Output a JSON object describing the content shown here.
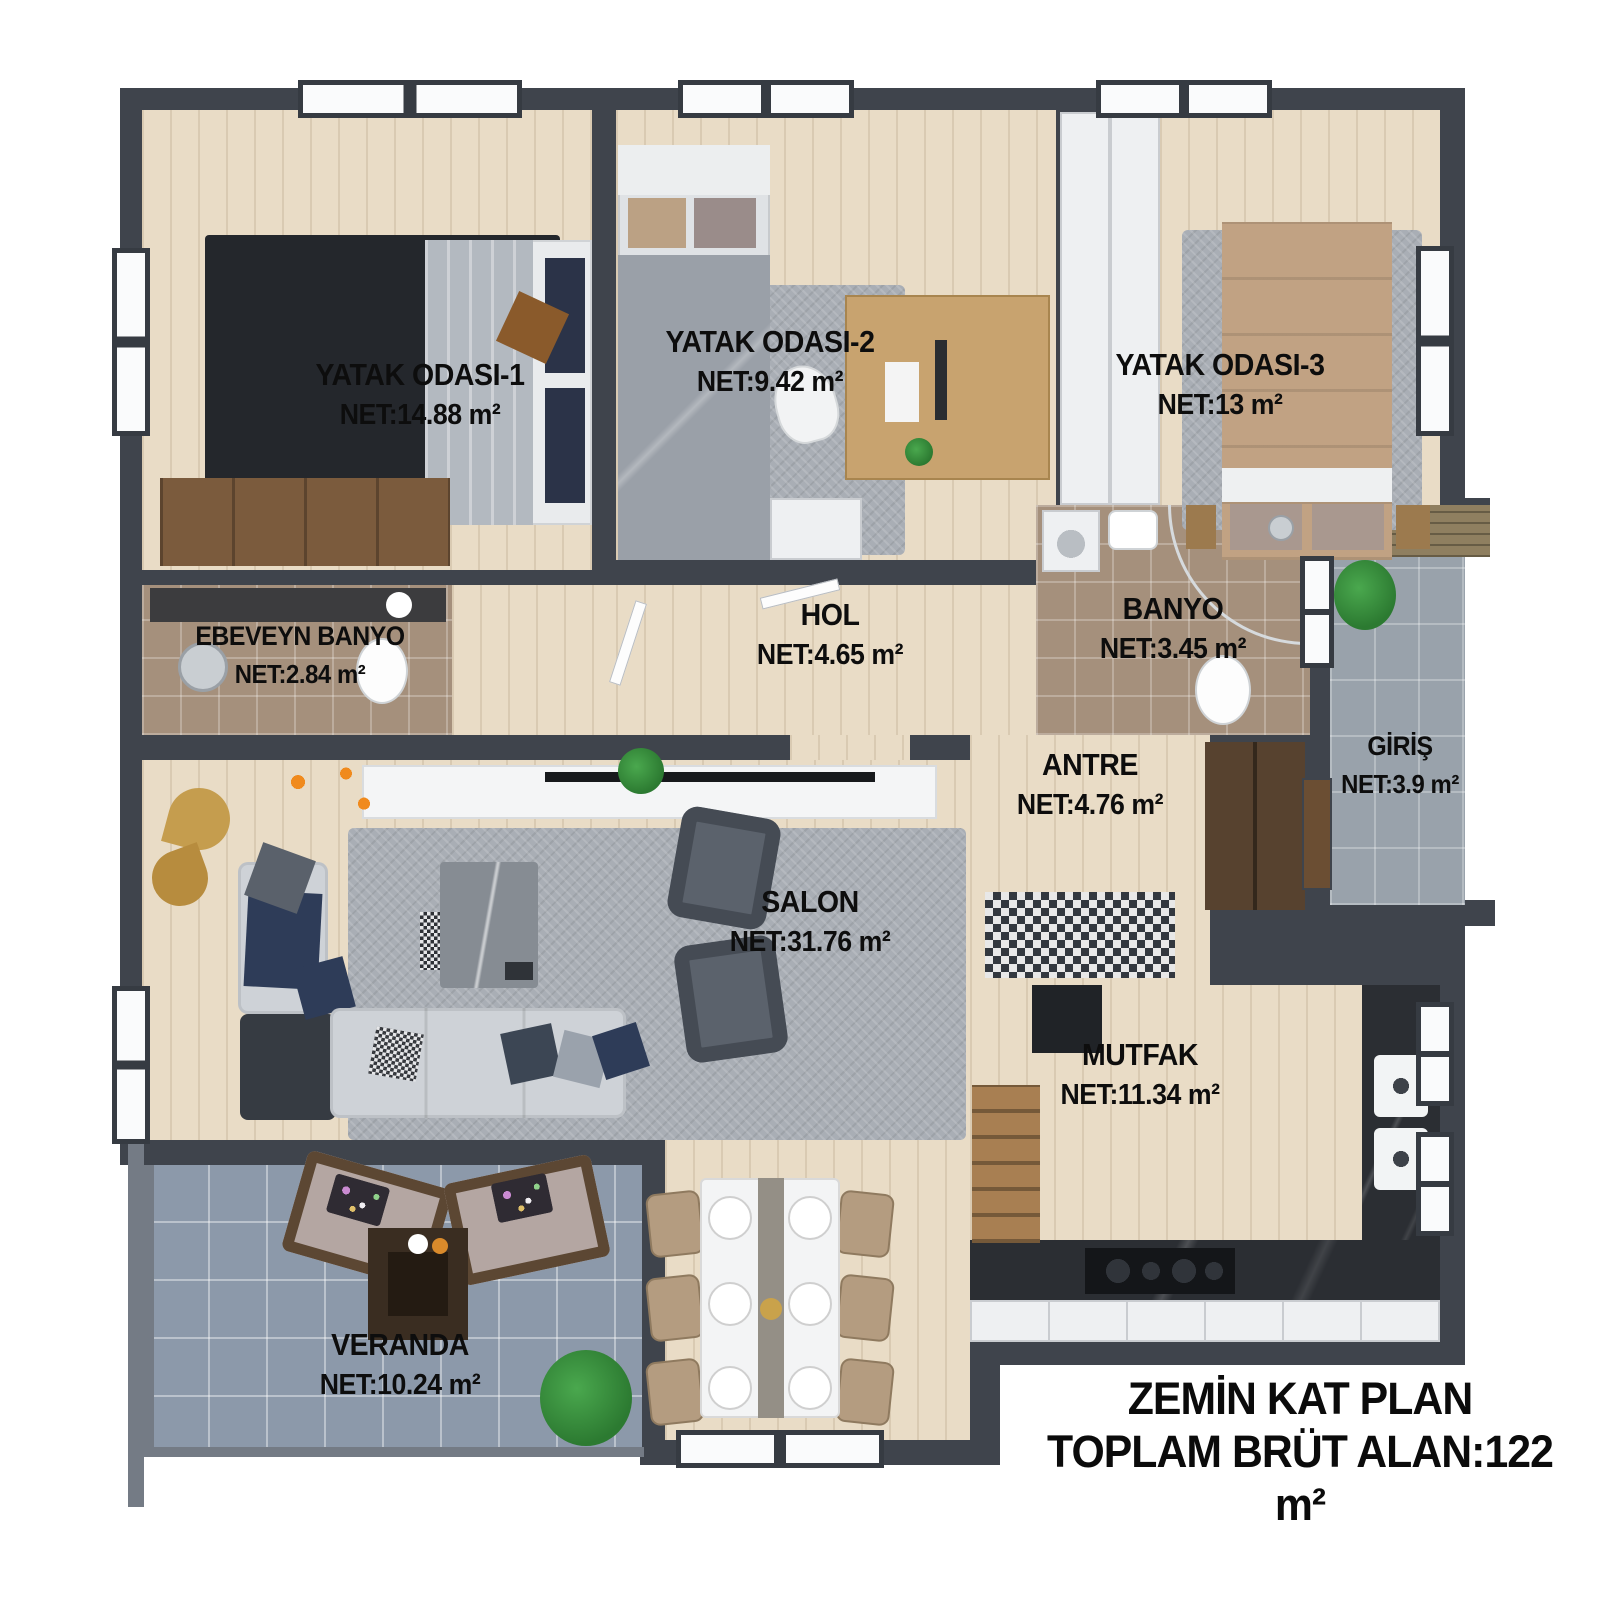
{
  "title": {
    "line1": "ZEMİN KAT PLAN",
    "line2": "TOPLAM BRÜT ALAN:122 m²"
  },
  "rooms": {
    "yatak1": {
      "name": "YATAK ODASI-1",
      "area": "NET:14.88 m²"
    },
    "yatak2": {
      "name": "YATAK ODASI-2",
      "area": "NET:9.42 m²"
    },
    "yatak3": {
      "name": "YATAK ODASI-3",
      "area": "NET:13 m²"
    },
    "ebeveyn_banyo": {
      "name": "EBEVEYN BANYO",
      "area": "NET:2.84 m²"
    },
    "hol": {
      "name": "HOL",
      "area": "NET:4.65 m²"
    },
    "banyo": {
      "name": "BANYO",
      "area": "NET:3.45 m²"
    },
    "antre": {
      "name": "ANTRE",
      "area": "NET:4.76 m²"
    },
    "giris": {
      "name": "GİRİŞ",
      "area": "NET:3.9 m²"
    },
    "salon": {
      "name": "SALON",
      "area": "NET:31.76 m²"
    },
    "mutfak": {
      "name": "MUTFAK",
      "area": "NET:11.34 m²"
    },
    "veranda": {
      "name": "VERANDA",
      "area": "NET:10.24 m²"
    }
  },
  "colors": {
    "wall": "#3f444c",
    "wood_floor": "#e9dcc6",
    "bath_tile": "#a5907c",
    "entry_tile": "#99a2ab",
    "veranda_tile": "#8c99aa",
    "rug": "#a9aeb5",
    "counter": "#2b2e33",
    "accent_wood": "#a87f52",
    "label_text": "#0d0d0d"
  }
}
